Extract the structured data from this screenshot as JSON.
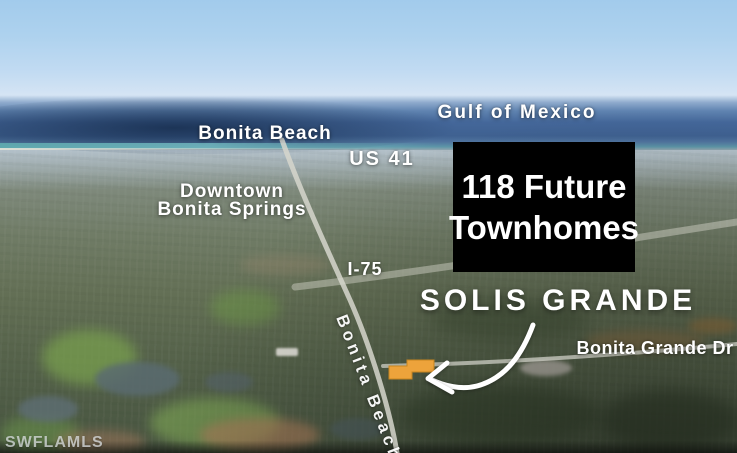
{
  "labels": {
    "gulf_of_mexico": "Gulf of Mexico",
    "bonita_beach": "Bonita Beach",
    "us_41": "US 41",
    "downtown_line1": "Downtown",
    "downtown_line2": "Bonita Springs",
    "i_75": "I-75",
    "bonita_beach_road": "Bonita Beach",
    "bonita_grande_dr": "Bonita Grande Dr"
  },
  "callout": {
    "line1": "118 Future",
    "line2": "Townhomes"
  },
  "project_title": "SOLIS GRANDE",
  "watermark": "SWFLAMLS",
  "colors": {
    "label_text": "#ffffff",
    "callout_bg": "#000000",
    "parcel_highlight": "#eda33b",
    "arrow": "#ffffff",
    "road": "#d6d6cd",
    "watermark_text": "#d9dde0",
    "sky_top": "#a2cbec",
    "ocean_deep": "#3f6191",
    "shoreline_teal": "#5fa7ab",
    "land_near": "#475440"
  }
}
